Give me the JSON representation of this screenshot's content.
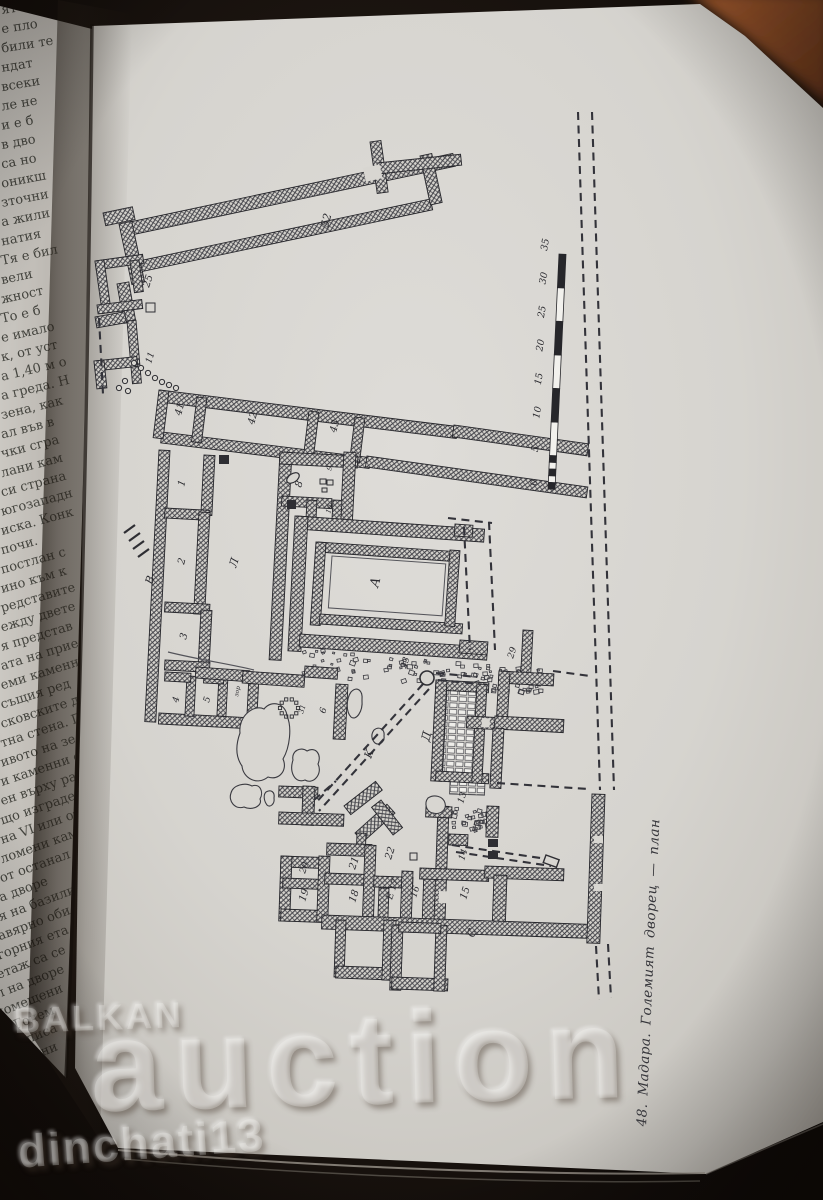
{
  "caption": {
    "text": "48. Мадара. Големият дворец — план"
  },
  "watermark": {
    "brand_top": "BALKAN",
    "brand_main": "auction",
    "username": "dinchati13"
  },
  "colors": {
    "paper": "#d8d6d1",
    "paper_left": "#c9c6c0",
    "ink": "#2e2e33",
    "cover": "#9a5329",
    "background": "#17110d"
  },
  "left_page": {
    "lines": [
      "ят",
      "е пло",
      "били те",
      "ндат",
      "всеки",
      "ле не",
      "и е б",
      "в дво",
      "са но",
      "оникш",
      "зточни",
      "а жили",
      "натия",
      "Тя е бил",
      "вели",
      "жност",
      "То е б",
      "е имало",
      "к, от уст",
      "а 1,40 м о",
      "а греда. Н",
      "зена, как",
      "ал във в",
      "чки сгра",
      "лани кам",
      "си страна",
      "югозападн",
      "иска. Конк",
      "почи.",
      "постлан с",
      "ино към к",
      "редставите",
      "ежду двете",
      "я представ",
      "ата на прие",
      "еми каменн",
      "същия ред",
      "сковските д",
      "тна стена. П",
      "ивото на зе",
      "и каменни о",
      "ен върху ра",
      "що изграде",
      "на VI или от",
      "ломени кам",
      "от останал",
      "а дворе",
      "я на базили",
      "авярно оби",
      "горния ета",
      "етаж са се",
      "л на дворе",
      "помещени",
      "на Голем",
      "два вписа",
      "вътрешни",
      "стена",
      "предполо",
      "таж",
      "ия"
    ]
  },
  "plan": {
    "scale_bar": {
      "labels": [
        "0",
        "5",
        "10",
        "15",
        "20",
        "25",
        "30",
        "35"
      ]
    },
    "labels": [
      [
        "52",
        328,
        228,
        -75,
        11
      ],
      [
        "25",
        149,
        288,
        -72,
        10
      ],
      [
        "11",
        151,
        364,
        -72,
        9
      ],
      [
        "41",
        181,
        416,
        -75,
        10
      ],
      [
        "42",
        254,
        425,
        -75,
        10
      ],
      [
        "43",
        336,
        433,
        -75,
        10
      ],
      [
        "1",
        184,
        487,
        -75,
        10
      ],
      [
        "2",
        184,
        565,
        -75,
        10
      ],
      [
        "3",
        186,
        640,
        -75,
        10
      ],
      [
        "4",
        178,
        703,
        -75,
        9
      ],
      [
        "5",
        209,
        703,
        -75,
        9
      ],
      [
        "В",
        152,
        585,
        -70,
        11
      ],
      [
        "Л",
        236,
        568,
        -72,
        11
      ],
      [
        "8",
        301,
        488,
        -72,
        10
      ],
      [
        "9",
        331,
        471,
        -72,
        7
      ],
      [
        "10",
        330,
        514,
        -72,
        7
      ],
      [
        "А",
        378,
        588,
        -75,
        13
      ],
      [
        "зор",
        238,
        697,
        -78,
        6
      ],
      [
        "31",
        303,
        714,
        -72,
        7
      ],
      [
        "6",
        325,
        714,
        -72,
        9
      ],
      [
        "23",
        406,
        669,
        -72,
        9
      ],
      [
        "К",
        371,
        759,
        -70,
        11
      ],
      [
        "Д",
        429,
        742,
        -75,
        12
      ],
      [
        "29",
        513,
        659,
        -72,
        9
      ],
      [
        "13",
        463,
        804,
        -72,
        9
      ],
      [
        "22",
        391,
        860,
        -72,
        10
      ],
      [
        "21",
        355,
        870,
        -72,
        10
      ],
      [
        "20",
        305,
        874,
        -72,
        9
      ],
      [
        "19",
        305,
        902,
        -72,
        10
      ],
      [
        "18",
        355,
        903,
        -72,
        10
      ],
      [
        "Е 17",
        392,
        900,
        -72,
        9
      ],
      [
        "16",
        416,
        898,
        -72,
        9
      ],
      [
        "14",
        464,
        861,
        -72,
        9
      ],
      [
        "15",
        466,
        900,
        -72,
        10
      ],
      [
        "С",
        474,
        938,
        -72,
        11
      ]
    ]
  }
}
